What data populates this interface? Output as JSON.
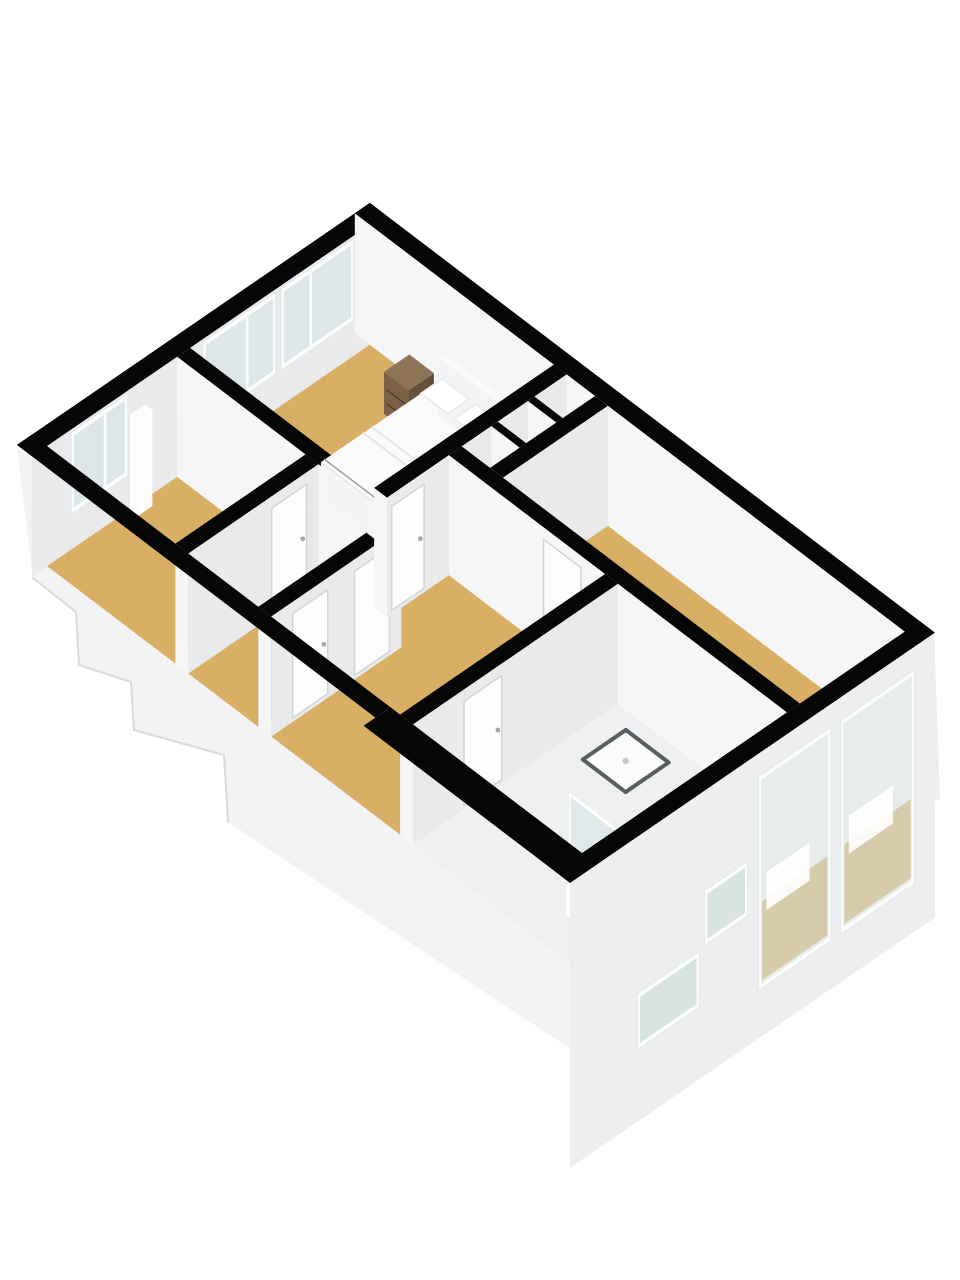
{
  "scene": {
    "width": 960,
    "height": 1280,
    "background": "#ffffff",
    "view": "3d-floorplan-isometric"
  },
  "projection": {
    "origin": [
      47,
      566
    ],
    "u_axis": [
      53.8,
      -36.9
    ],
    "v_axis": [
      53.5,
      40.7
    ],
    "wall_top_dy": -120,
    "ext_skirt_dy": 165
  },
  "palette": {
    "black": "#060606",
    "faceSE": "#e8eaeb",
    "faceSW": "#f5f6f7",
    "extSE": "#eceef0",
    "base": "#f2f3f5",
    "stepEdge": "#d8dadc",
    "tan": "#d8af64",
    "pale": "#eef0f2",
    "glassIn": "#dde7e9",
    "glassOut": "rgba(203,219,216,0.45)",
    "glassSlit": "rgba(208,223,221,0.85)",
    "frame": "#fbfcfc",
    "frameStroke": "#e6e8e8",
    "door": "#fdfdfe",
    "doorStroke": "#d2d5d7",
    "handle": "#a3a8ab",
    "brownTop": "#8d7457",
    "brownFront": "#64503c",
    "brownSide": "#7a6148",
    "brownLine": "#4e3c2c",
    "bedTop": "#fbfbfc",
    "bedFront": "#e9eaec",
    "bedSide": "#f3f4f6",
    "bedLine": "#9b9ea1",
    "foldLine": "#e4e6e8",
    "pillow": "#ffffff",
    "pillowStroke": "#ebedef",
    "trayFill": "#fafbfb",
    "trayRim": "#5a5e60",
    "drain": "#c6c9cb",
    "glassPanel": "rgba(210,226,223,0.5)",
    "glassEdge": "rgba(255,255,255,0.95)",
    "toilet": "#ffffff",
    "toiletStroke": "#d8dbdd",
    "decorTan": "#c9ae74",
    "decorWhite": "#ffffff"
  },
  "base": {
    "silhouette": [
      [
        17,
        447
      ],
      [
        33,
        578
      ],
      [
        76,
        612
      ],
      [
        79,
        665
      ],
      [
        131,
        682
      ],
      [
        134,
        730
      ],
      [
        224,
        755
      ],
      [
        228,
        822
      ],
      [
        590,
        1062
      ],
      [
        940,
        798
      ],
      [
        934,
        632
      ],
      [
        582,
        875
      ]
    ],
    "se_face": [
      [
        582,
        875
      ],
      [
        934,
        632
      ],
      [
        940,
        798
      ],
      [
        590,
        1062
      ]
    ],
    "step_edges": [
      [
        [
          33,
          578
        ],
        [
          76,
          612
        ]
      ],
      [
        [
          76,
          612
        ],
        [
          79,
          665
        ]
      ],
      [
        [
          79,
          665
        ],
        [
          131,
          682
        ]
      ],
      [
        [
          131,
          682
        ],
        [
          134,
          730
        ]
      ],
      [
        [
          134,
          730
        ],
        [
          224,
          755
        ]
      ],
      [
        [
          224,
          755
        ],
        [
          228,
          822
        ]
      ]
    ]
  },
  "floors": [
    {
      "id": "floor-room-a",
      "color": "tan",
      "poly": [
        [
          0,
          0
        ],
        [
          2.42,
          0
        ],
        [
          2.42,
          2.4
        ],
        [
          0,
          2.4
        ]
      ]
    },
    {
      "id": "floor-room-b",
      "color": "tan",
      "poly": [
        [
          0,
          2.64
        ],
        [
          2.42,
          2.64
        ],
        [
          2.42,
          3.95
        ],
        [
          0,
          3.95
        ]
      ]
    },
    {
      "id": "floor-bedroom",
      "color": "tan",
      "poly": [
        [
          2.66,
          0
        ],
        [
          6,
          0
        ],
        [
          6,
          3.44
        ],
        [
          2.66,
          3.44
        ]
      ]
    },
    {
      "id": "floor-hallway",
      "color": "tan",
      "poly": [
        [
          0,
          4.19
        ],
        [
          2.42,
          4.19
        ],
        [
          2.42,
          3.68
        ],
        [
          3.81,
          3.68
        ],
        [
          3.81,
          6.6
        ],
        [
          0,
          6.6
        ]
      ]
    },
    {
      "id": "floor-closet-1",
      "color": "pale",
      "poly": [
        [
          4.05,
          3.68
        ],
        [
          4.6,
          3.68
        ],
        [
          4.6,
          4.21
        ],
        [
          4.05,
          4.21
        ]
      ]
    },
    {
      "id": "floor-closet-2",
      "color": "pale",
      "poly": [
        [
          4.72,
          3.68
        ],
        [
          5.28,
          3.68
        ],
        [
          5.28,
          4.21
        ],
        [
          4.72,
          4.21
        ]
      ]
    },
    {
      "id": "floor-closet-3",
      "color": "pale",
      "poly": [
        [
          5.4,
          3.68
        ],
        [
          6,
          3.68
        ],
        [
          6,
          4.21
        ],
        [
          5.4,
          4.21
        ]
      ]
    },
    {
      "id": "floor-living",
      "color": "tan",
      "poly": [
        [
          4.05,
          4.45
        ],
        [
          6,
          4.45
        ],
        [
          6,
          10
        ],
        [
          4.05,
          10
        ]
      ]
    },
    {
      "id": "floor-bathroom",
      "color": "pale",
      "poly": [
        [
          0,
          6.84
        ],
        [
          3.81,
          6.84
        ],
        [
          3.81,
          10
        ],
        [
          0,
          10
        ]
      ]
    }
  ],
  "walls": [
    {
      "id": "wall-nw",
      "rect": [
        -0.28,
        -0.28,
        6.28,
        0
      ],
      "faces": [
        "top",
        "+v"
      ]
    },
    {
      "id": "wall-ne",
      "rect": [
        6,
        -0.28,
        6.28,
        10.28
      ],
      "faces": [
        "top",
        "-u"
      ]
    },
    {
      "id": "wall-iw1",
      "rect": [
        2.42,
        0,
        2.66,
        3.68
      ],
      "faces": [
        "top",
        "+v",
        "-u"
      ]
    },
    {
      "id": "wall-iw2",
      "rect": [
        0,
        2.4,
        2.42,
        2.64
      ],
      "faces": [
        "top",
        "+v",
        "-u"
      ]
    },
    {
      "id": "wall-iw3",
      "rect": [
        0,
        3.95,
        2.42,
        4.19
      ],
      "faces": [
        "top",
        "+v",
        "-u"
      ]
    },
    {
      "id": "wall-iw5",
      "rect": [
        2.66,
        3.44,
        6,
        3.68
      ],
      "faces": [
        "top",
        "+v",
        "-u"
      ]
    },
    {
      "id": "wall-cd1",
      "rect": [
        4.6,
        3.68,
        4.72,
        4.21
      ],
      "faces": [
        "top",
        "+v",
        "-u"
      ]
    },
    {
      "id": "wall-cd2",
      "rect": [
        5.28,
        3.68,
        5.4,
        4.21
      ],
      "faces": [
        "top",
        "+v",
        "-u"
      ]
    },
    {
      "id": "wall-closet-se",
      "rect": [
        4.05,
        4.21,
        6,
        4.45
      ],
      "faces": [
        "top",
        "+v",
        "-u"
      ]
    },
    {
      "id": "wall-long",
      "rect": [
        3.81,
        3.68,
        4.05,
        10
      ],
      "faces": [
        "top",
        "+v",
        "-u"
      ]
    },
    {
      "id": "wall-iw7",
      "rect": [
        0,
        6.6,
        3.81,
        6.84
      ],
      "faces": [
        "top",
        "+v",
        "-u"
      ]
    },
    {
      "id": "wall-se",
      "rect": [
        -0.5,
        10,
        6.28,
        10.28
      ],
      "faces": [
        "top",
        "+v"
      ],
      "ext": true
    },
    {
      "id": "wall-sw-a",
      "rect": [
        -0.28,
        -0.28,
        0,
        6.42
      ],
      "faces": [
        "top"
      ]
    },
    {
      "id": "wall-sw-b",
      "rect": [
        -0.5,
        6.42,
        0,
        10.28
      ],
      "faces": [
        "top"
      ]
    }
  ],
  "windows": [
    {
      "id": "window-room-a",
      "at": 0,
      "range": [
        0.5,
        1.45
      ],
      "dy": [
        -112,
        -40
      ],
      "glass": "glassIn",
      "mullions": [
        1.08
      ]
    },
    {
      "id": "window-bedroom-1",
      "at": 0,
      "range": [
        2.95,
        4.2
      ],
      "dy": [
        -112,
        -40
      ],
      "glass": "glassIn",
      "mullions": [
        3.72
      ]
    },
    {
      "id": "window-bedroom-2",
      "at": 0,
      "range": [
        4.4,
        5.65
      ],
      "dy": [
        -112,
        -40
      ],
      "glass": "glassIn",
      "mullions": [
        4.9
      ]
    },
    {
      "id": "window-living-1",
      "at": 10.28,
      "range": [
        3.05,
        4.3
      ],
      "dy": [
        -92,
        112
      ],
      "glass": "glassOut",
      "decor": true
    },
    {
      "id": "window-living-2",
      "at": 10.28,
      "range": [
        4.58,
        5.85
      ],
      "dy": [
        -92,
        112
      ],
      "glass": "glassOut",
      "decor": true
    },
    {
      "id": "window-slit-1",
      "at": 10.28,
      "range": [
        2.05,
        2.75
      ],
      "dy": [
        -15,
        30
      ],
      "glass": "glassSlit"
    },
    {
      "id": "window-slit-2",
      "at": 10.28,
      "range": [
        0.8,
        1.85
      ],
      "dy": [
        42,
        88
      ],
      "glass": "glassSlit"
    }
  ],
  "doors": [
    {
      "id": "door-room-ab",
      "axis": "v",
      "at": 2.64,
      "range": [
        1.55,
        2.2
      ]
    },
    {
      "id": "door-room-b",
      "axis": "v",
      "at": 4.19,
      "range": [
        0.4,
        1.05
      ]
    },
    {
      "id": "door-hall-b",
      "axis": "v",
      "at": 4.19,
      "range": [
        1.55,
        2.2
      ]
    },
    {
      "id": "door-bedroom",
      "axis": "v",
      "at": 3.68,
      "range": [
        2.75,
        3.35
      ]
    },
    {
      "id": "door-living",
      "axis": "u",
      "at": 3.81,
      "range": [
        5.45,
        6.15
      ]
    },
    {
      "id": "door-bathroom",
      "axis": "v",
      "at": 6.84,
      "range": [
        0.95,
        1.65
      ]
    }
  ],
  "furniture": {
    "panel_nw": {
      "kind": "box",
      "rect": [
        1.52,
        0.02,
        1.8,
        0.16
      ],
      "top": -96,
      "cols": {
        "top": "door",
        "pv": "door",
        "mu": "door"
      }
    },
    "nightstand_1": {
      "kind": "nightstand",
      "rect": [
        5.25,
        1.02,
        5.72,
        1.48
      ],
      "top": -42
    },
    "nightstand_2": {
      "kind": "nightstand",
      "rect": [
        5.25,
        3.0,
        5.72,
        3.42
      ],
      "top": -42
    },
    "bed": {
      "kind": "bed",
      "rect": [
        3.55,
        1.55,
        5.77,
        2.95
      ],
      "top": -36,
      "headboard": [
        5.77,
        1.5,
        5.86,
        3.0
      ],
      "hb_top": -58,
      "pillows": [
        [
          5.28,
          1.68,
          5.68,
          2.18
        ],
        [
          5.28,
          2.3,
          5.68,
          2.8
        ]
      ],
      "pillow_dy": -46,
      "folds": [
        4.5,
        4.34
      ],
      "frame_u": 3.62
    },
    "shower_tray": {
      "kind": "tray",
      "rect": [
        2.7,
        7.3,
        3.5,
        8.1
      ],
      "drain": [
        3.1,
        7.7
      ]
    },
    "toilet": {
      "kind": "toilet",
      "center": [
        0.95,
        9.35
      ],
      "rx": 15,
      "ry": 10,
      "tank": [
        0.58,
        9.12,
        0.82,
        9.55
      ],
      "tank_top": -30
    },
    "glass_b": {
      "kind": "glass",
      "axis": "v",
      "at": 9.63,
      "range": [
        1.17,
        2.2
      ],
      "top": -78
    },
    "glass_a": {
      "kind": "glass",
      "axis": "u",
      "at": 1.17,
      "range": [
        8.6,
        9.63
      ],
      "top": -78
    }
  },
  "paint_order": [
    "base",
    "floors",
    "wall:wall-nw",
    "furn:panel_nw",
    "win:window-room-a",
    "win:window-bedroom-1",
    "win:window-bedroom-2",
    "wall:wall-ne",
    "wall:wall-iw1",
    "wall:wall-iw2",
    "door:door-room-ab",
    "wall:wall-iw3",
    "door:door-room-b",
    "door:door-hall-b",
    "furn:nightstand_1",
    "furn:bed",
    "furn:nightstand_2",
    "wall:wall-iw5",
    "door:door-bedroom",
    "wall:wall-cd1",
    "wall:wall-cd2",
    "wall:wall-closet-se",
    "wall:wall-long",
    "door:door-living",
    "wall:wall-iw7",
    "door:door-bathroom",
    "furn:shower_tray",
    "furn:toilet",
    "furn:glass_b",
    "furn:glass_a",
    "wall:wall-se",
    "win:window-living-1",
    "win:window-living-2",
    "win:window-slit-1",
    "win:window-slit-2",
    "wall:wall-sw-a",
    "wall:wall-sw-b"
  ]
}
